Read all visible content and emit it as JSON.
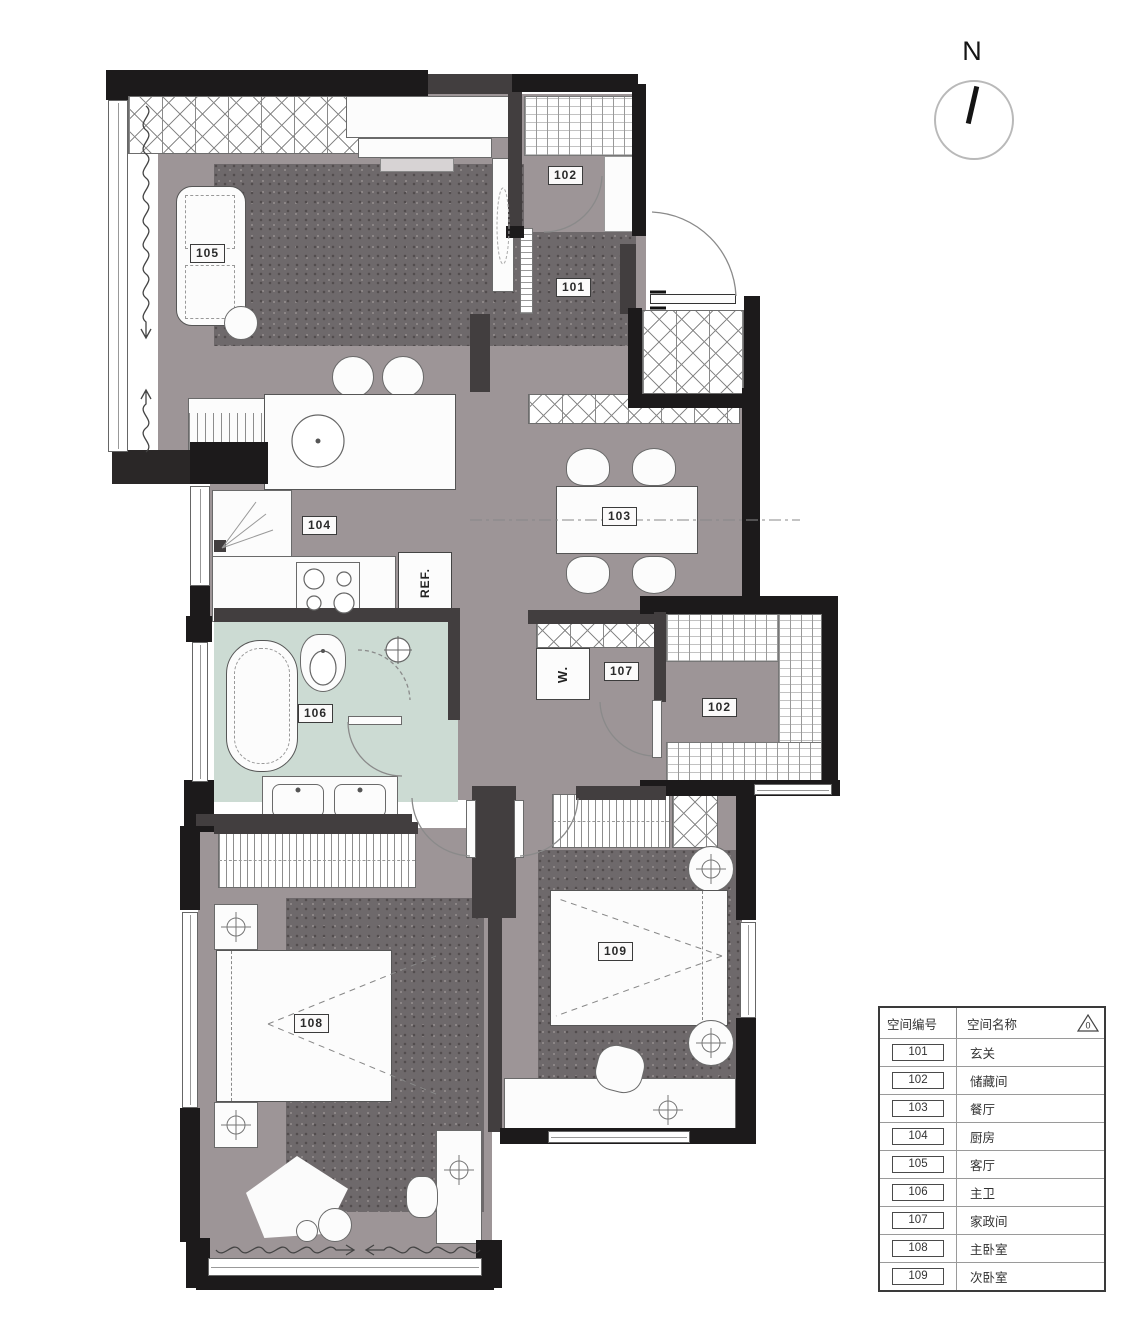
{
  "compass": {
    "label": "N"
  },
  "rooms": {
    "living": "105",
    "closet_top": "102",
    "entry": "101",
    "dining": "103",
    "kitchen": "104",
    "bath": "106",
    "utility": "107",
    "storage": "102",
    "master": "108",
    "second": "109"
  },
  "appliances": {
    "fridge": "REF.",
    "washer": "W."
  },
  "legend": {
    "col_code": "空间编号",
    "col_name": "空间名称",
    "revision": "0",
    "rows": [
      {
        "code": "101",
        "name": "玄关"
      },
      {
        "code": "102",
        "name": "储藏间"
      },
      {
        "code": "103",
        "name": "餐厅"
      },
      {
        "code": "104",
        "name": "厨房"
      },
      {
        "code": "105",
        "name": "客厅"
      },
      {
        "code": "106",
        "name": "主卫"
      },
      {
        "code": "107",
        "name": "家政间"
      },
      {
        "code": "108",
        "name": "主卧室"
      },
      {
        "code": "109",
        "name": "次卧室"
      }
    ]
  }
}
